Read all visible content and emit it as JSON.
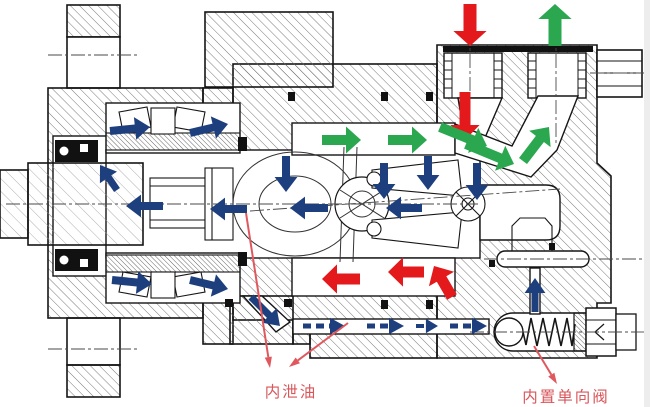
{
  "diagram": {
    "title": "bent-axis piston pump cross-section",
    "labels": {
      "internal_leak_oil": {
        "text": "内泄油"
      },
      "built_in_check_valve": {
        "text": "内置单向阀"
      }
    },
    "colors": {
      "inlet_flow": "#E3191C",
      "outlet_flow": "#2BA750",
      "leak_flow": "#1E3F7E",
      "label_text": "#D9565B",
      "leader_line": "#E0585E",
      "outline": "#151515"
    },
    "flows": {
      "inlet": {
        "color_key": "inlet_flow",
        "arrows": [
          {
            "x1": 470,
            "y1": 4,
            "x2": 470,
            "y2": 46,
            "w": 13
          },
          {
            "x1": 465,
            "y1": 92,
            "x2": 465,
            "y2": 140,
            "w": 11
          },
          {
            "x1": 360,
            "y1": 279,
            "x2": 322,
            "y2": 279,
            "w": 11
          },
          {
            "x1": 424,
            "y1": 272,
            "x2": 388,
            "y2": 272,
            "w": 11
          },
          {
            "x1": 452,
            "y1": 297,
            "x2": 434,
            "y2": 266,
            "w": 11
          }
        ]
      },
      "outlet": {
        "color_key": "outlet_flow",
        "arrows": [
          {
            "x1": 555,
            "y1": 46,
            "x2": 555,
            "y2": 4,
            "w": 13
          },
          {
            "x1": 322,
            "y1": 140,
            "x2": 361,
            "y2": 140,
            "w": 10
          },
          {
            "x1": 388,
            "y1": 140,
            "x2": 427,
            "y2": 140,
            "w": 10
          },
          {
            "x1": 440,
            "y1": 127,
            "x2": 487,
            "y2": 146,
            "w": 10
          },
          {
            "x1": 466,
            "y1": 144,
            "x2": 514,
            "y2": 164,
            "w": 10
          },
          {
            "x1": 523,
            "y1": 161,
            "x2": 549,
            "y2": 127,
            "w": 10
          }
        ]
      },
      "leak": {
        "color_key": "leak_flow",
        "arrows": [
          {
            "x1": 110,
            "y1": 131,
            "x2": 150,
            "y2": 127,
            "w": 8
          },
          {
            "x1": 190,
            "y1": 133,
            "x2": 228,
            "y2": 124,
            "w": 8
          },
          {
            "x1": 117,
            "y1": 190,
            "x2": 100,
            "y2": 165,
            "w": 7
          },
          {
            "x1": 163,
            "y1": 206,
            "x2": 126,
            "y2": 206,
            "w": 8
          },
          {
            "x1": 247,
            "y1": 209,
            "x2": 210,
            "y2": 209,
            "w": 8
          },
          {
            "x1": 328,
            "y1": 208,
            "x2": 290,
            "y2": 208,
            "w": 8
          },
          {
            "x1": 422,
            "y1": 208,
            "x2": 386,
            "y2": 208,
            "w": 8
          },
          {
            "x1": 286,
            "y1": 156,
            "x2": 286,
            "y2": 192,
            "w": 8
          },
          {
            "x1": 384,
            "y1": 163,
            "x2": 384,
            "y2": 199,
            "w": 8
          },
          {
            "x1": 428,
            "y1": 156,
            "x2": 428,
            "y2": 190,
            "w": 8
          },
          {
            "x1": 477,
            "y1": 163,
            "x2": 477,
            "y2": 200,
            "w": 8
          },
          {
            "x1": 112,
            "y1": 280,
            "x2": 152,
            "y2": 284,
            "w": 8
          },
          {
            "x1": 190,
            "y1": 280,
            "x2": 228,
            "y2": 289,
            "w": 8
          },
          {
            "x1": 251,
            "y1": 297,
            "x2": 280,
            "y2": 326,
            "w": 7
          },
          {
            "x1": 303,
            "y1": 326,
            "x2": 345,
            "y2": 326,
            "w": 5,
            "dashed": true
          },
          {
            "x1": 367,
            "y1": 326,
            "x2": 404,
            "y2": 326,
            "w": 5,
            "dashed": true
          },
          {
            "x1": 416,
            "y1": 326,
            "x2": 438,
            "y2": 326,
            "w": 4,
            "dashed": true
          },
          {
            "x1": 450,
            "y1": 326,
            "x2": 487,
            "y2": 326,
            "w": 5,
            "dashed": true
          },
          {
            "x1": 535,
            "y1": 312,
            "x2": 535,
            "y2": 278,
            "w": 7
          }
        ]
      }
    },
    "leaders": [
      {
        "x1": 246,
        "y1": 213,
        "x2": 270,
        "y2": 368
      },
      {
        "x1": 348,
        "y1": 323,
        "x2": 289,
        "y2": 367
      },
      {
        "x1": 534,
        "y1": 346,
        "x2": 557,
        "y2": 384
      }
    ]
  }
}
